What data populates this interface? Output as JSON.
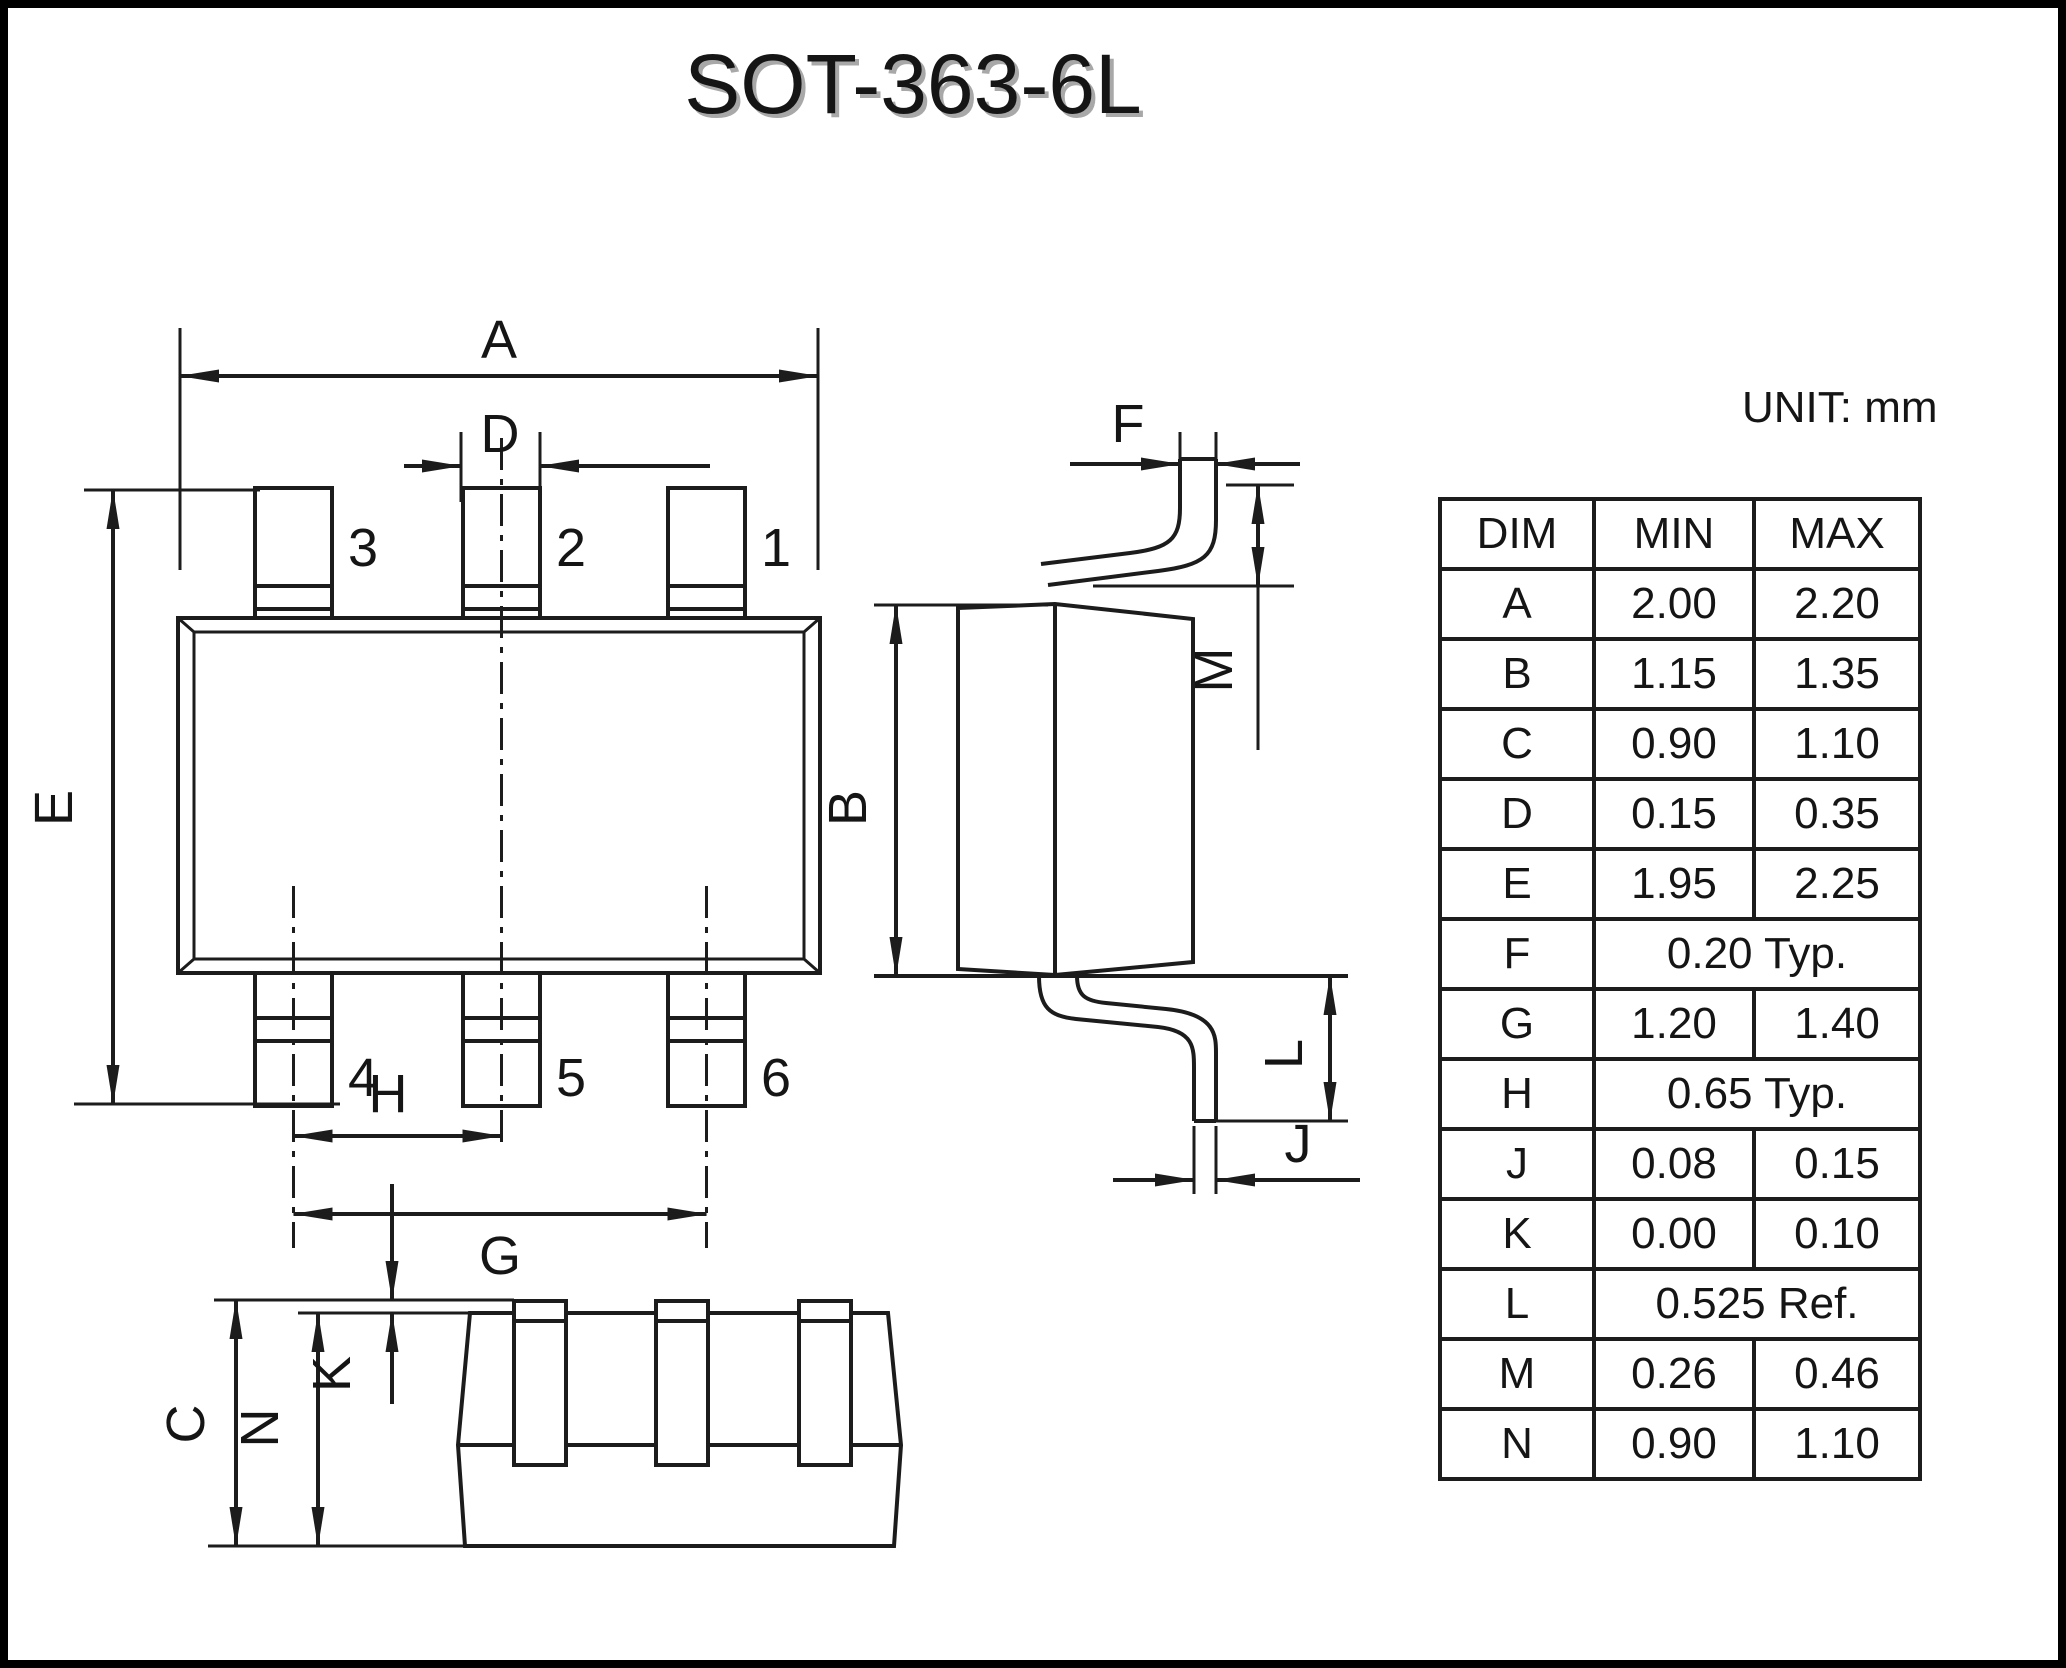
{
  "title": "SOT-363-6L",
  "unit_label": "UNIT: mm",
  "dims": {
    "A": "A",
    "B": "B",
    "C": "C",
    "D": "D",
    "E": "E",
    "F": "F",
    "G": "G",
    "H": "H",
    "J": "J",
    "K": "K",
    "L": "L",
    "M": "M",
    "N": "N"
  },
  "pins": [
    "1",
    "2",
    "3",
    "4",
    "5",
    "6"
  ],
  "table": {
    "headers": [
      "DIM",
      "MIN",
      "MAX"
    ],
    "rows": [
      {
        "dim": "A",
        "min": "2.00",
        "max": "2.20"
      },
      {
        "dim": "B",
        "min": "1.15",
        "max": "1.35"
      },
      {
        "dim": "C",
        "min": "0.90",
        "max": "1.10"
      },
      {
        "dim": "D",
        "min": "0.15",
        "max": "0.35"
      },
      {
        "dim": "E",
        "min": "1.95",
        "max": "2.25"
      },
      {
        "dim": "F",
        "span": "0.20 Typ."
      },
      {
        "dim": "G",
        "min": "1.20",
        "max": "1.40"
      },
      {
        "dim": "H",
        "span": "0.65 Typ."
      },
      {
        "dim": "J",
        "min": "0.08",
        "max": "0.15"
      },
      {
        "dim": "K",
        "min": "0.00",
        "max": "0.10"
      },
      {
        "dim": "L",
        "span": "0.525 Ref."
      },
      {
        "dim": "M",
        "min": "0.26",
        "max": "0.46"
      },
      {
        "dim": "N",
        "min": "0.90",
        "max": "1.10"
      }
    ]
  }
}
